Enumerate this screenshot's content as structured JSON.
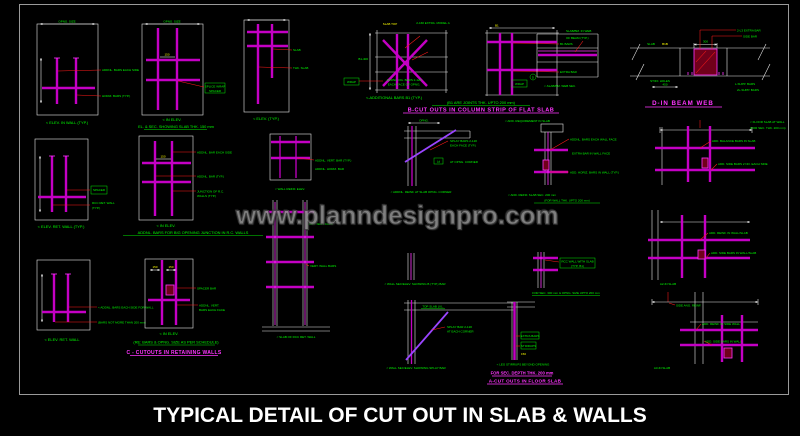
{
  "sheet": {
    "title": "TYPICAL DETAIL OF CUT OUT IN SLAB & WALLS",
    "watermark": "www.planndesignpro.com"
  },
  "colors": {
    "background": "#000000",
    "frame": "#9a9a9a",
    "dimension_lines": "#e8e8e8",
    "rebar_magenta": "#c400c4",
    "rebar_bright": "#ff35ff",
    "splay_purple": "#9a45ff",
    "label_green": "#00ff00",
    "dim_yellow": "#ffff00",
    "leader_red": "#ff1a1a",
    "watermark_gray": "#919191",
    "title_white": "#ffffff"
  },
  "panels": {
    "p1": {
      "dim_top": "OPNG. SIZE",
      "label1": "ADDNL. BARS EACH SIDE",
      "label2": "HORIZ. BARS (TYP.)",
      "caption": "< ELEV. IN WALL (TYP.)"
    },
    "p2": {
      "dim_top": "OPNG. SIZE",
      "dim1": "150",
      "box1": "SPLICE WRAP",
      "box2": "SPACER",
      "caption_small": "< IN ELEV.",
      "note": "EL. & SEC. SHOWING SLAB THK. 150 mm"
    },
    "p3": {
      "label1": "SLAB",
      "label2": "THK. SLAB",
      "caption": "< ELEV. (TYP.)"
    },
    "p4": {
      "yellow1": "SLAB TOP",
      "note_top": "2-16# EXTRA. MODEL A",
      "label_left": "B1-400",
      "box": "WRAP",
      "note_mid1": "ADDNL. DG. BARS 2-12#",
      "note_mid2": "EACH FACE OF OPNG.",
      "caption": "<-ADDITIONAL BARS B1 (TYP.)",
      "note_green": "(B1 ARE JOINTS THK. UPTO 200 mm)",
      "section": "B-CUT OUTS IN COLUMN STRIP OF FLAT SLAB"
    },
    "p5": {
      "yellow1": "B1",
      "label1": "B1 BARS",
      "label2": "EXTRA BAR",
      "box": "WRAP"
    },
    "p6": {
      "label1": "SLAB/BM. IN WEB",
      "label2": "OF BEAM (TYP.)",
      "circle": "D",
      "caption": "<-SLAB/BM. WEB SEC."
    },
    "p7": {
      "leader1": "2-L3 EXTRA BAR",
      "leader2": "SIDE BAR",
      "dim_green": "SLAB",
      "dim_yellow": "B1B",
      "dim": "300",
      "label1": "STIFF. HOLES",
      "dim2": "450",
      "label2": "L-SUPP. BARS",
      "label3": "2L-SUPP. BARS",
      "section": "D-IN BEAM WEB"
    },
    "p8": {
      "box": "SPACER",
      "label1": "RCC RET. WALL",
      "label2": "(TYP.)",
      "caption": "< ELEV. RET. WALL (TYP.)"
    },
    "p9": {
      "dim1": "150",
      "label1": "ADDNL. BAR EACH SIDE",
      "label2": "ADDNL. BAR (TYP.)",
      "label3": "JUNCTION OF R.C.",
      "label4": "WALLS (TYP.)",
      "caption_small": "< IN ELEV.",
      "note": "ADDNL. BARS FOR BIG OPENING JUNCTION IN R.C. WALLS"
    },
    "p10": {
      "label1": "ADDNL. VERT. BAR (TYP.)",
      "label2": "ADDNL. HORIZ. BAR",
      "caption": "< WALL REINF. ELEV."
    },
    "p11": {
      "label1": "RET. WALL FACE",
      "label2": "VERT. WALL BARS",
      "caption": "< SLAB OF RCC RET. WALL"
    },
    "p12": {
      "dim_top": "OPNG.",
      "note1": "SPLAY BARS 2-12#",
      "note2": "EACH FACE (TYP.)",
      "box": "Ld",
      "note3": "AT OPNG. CORNER",
      "caption": "< ADDNL. REINF. AT SLAB OPNG. CORNER"
    },
    "p13": {
      "label1": "ADDNL. BARS EACH WALL FACE",
      "label2": "EXTRA BAR IN WALL FACE",
      "label3": "ADD. HORIZ. BARS IN WALL (TYP.)",
      "caption_small": "< ADD. REINF. SLAB SEC. 200 mm",
      "note": "(FOR WALL THK. UPTO 200 mm)"
    },
    "p13b": {
      "box1": "RCC WALL WITH SLAB",
      "box2": "(TYP. B1)",
      "note": "FOR SEC. 300 mm & OPNG. SIZE UPTO 200 mm"
    },
    "p14": {
      "label1": "ADD. BALANCE BARS IN SLAB",
      "label2": "ADD. SIDE BARS 2 NO. EACH SIDE"
    },
    "p15": {
      "label1": "ADD. REINF. IN WALL/SLAB",
      "label2": "ADD. SIDE BARS IN WALL/SLAB",
      "caption": "A2-IN SLAB"
    },
    "p16": {
      "label1": "< ADDNL. BARS EACH SIDE FOR WALL",
      "label2": "(BARS NOT MORE THAN 200 mm)",
      "caption": "< ELEV. RET. WALL"
    },
    "p17": {
      "dim1": "150",
      "dim2": "150",
      "label1": "SPACER BAR",
      "label2": "ADDNL. VERT.",
      "label3": "BARS EACH FACE",
      "caption_small": "< IN ELEV.",
      "note": "(RE: BARS & OPNG. SIZE AS PER SCHEDULE)",
      "section": "C - CUTOUTS IN RETAINING WALLS"
    },
    "p18a": {
      "caption": "< WALL SEC/ELEV. SHOWING B (TYP.) BAR"
    },
    "p18b": {
      "label1": "TOP SLAB LVL.",
      "note1": "SPLAY BAR 2-12#",
      "note2": "AT EACH CORNER",
      "caption": "< WALL SEC/ELEV. SHOWING SPLAY BAR"
    },
    "p19": {
      "box1": "EXTRA BARS",
      "box2": "STIRRUPS",
      "dim1": "150",
      "caption_small": "< LEG STIRRUPS BEYOND OPENING",
      "note": "FOR SEC. DEPTH THK. 200 mm",
      "section": "A-CUT OUTS IN FLOOR SLAB"
    },
    "p20": {
      "label_top": "SIDE ANG. REINF.",
      "label1": "ADD. REINF. IN SIDE WALL",
      "label2": "ADD. SIDE BARS IN WALL",
      "caption": "A3-IN SLAB"
    },
    "misc": {
      "right1": "< FLOOR SLAB AT WALL",
      "right2": "(FOR SEC. THK. 200 mm)",
      "top1": "< ADD. REQUIREMENT IN SLAB"
    }
  }
}
